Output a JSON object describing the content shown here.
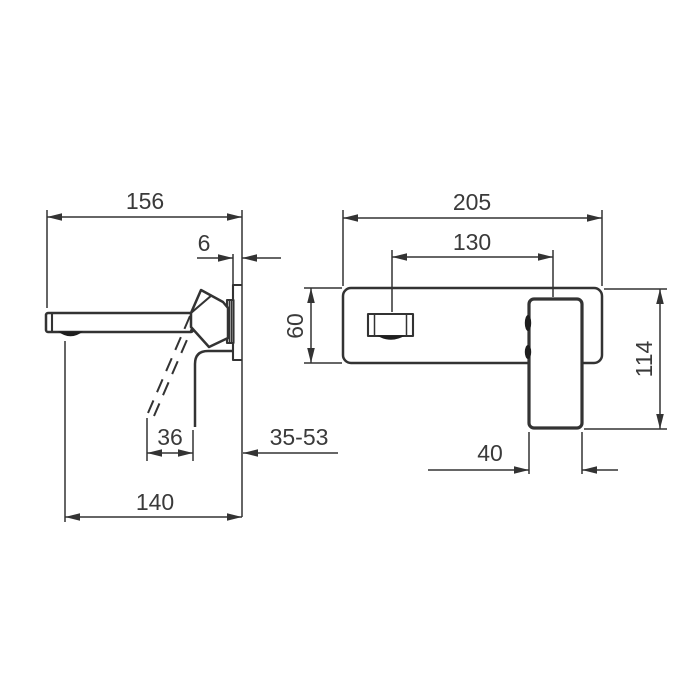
{
  "colors": {
    "background": "#ffffff",
    "line": "#333333",
    "text": "#3a3a3a",
    "ink": "#1e1e1e"
  },
  "side_view": {
    "reach": "156",
    "plate_thickness": "6",
    "lever_offset": "36",
    "wall_depth_range": "35-53",
    "spout_length": "140"
  },
  "front_view": {
    "plate_width": "205",
    "center_distance": "130",
    "plate_height": "60",
    "handle_height": "114",
    "handle_width": "40"
  }
}
